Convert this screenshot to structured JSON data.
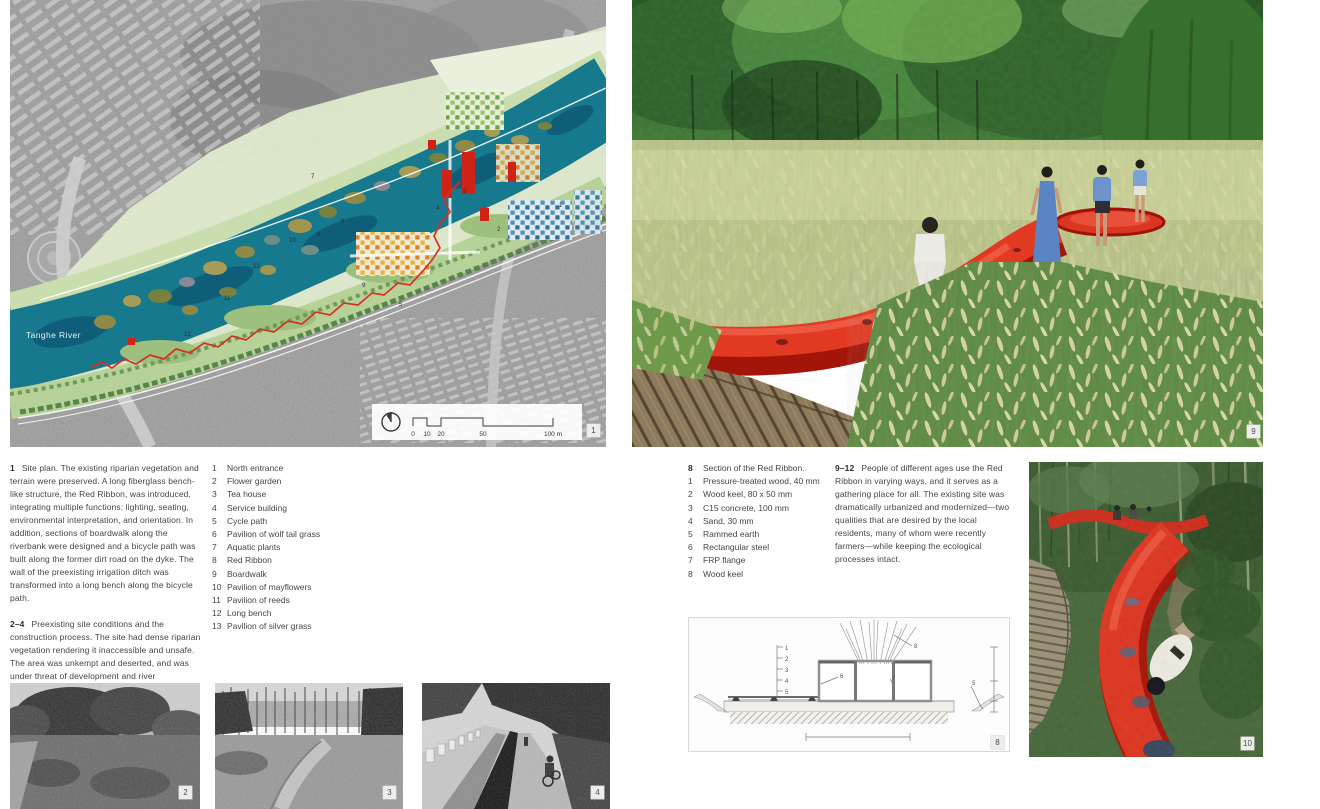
{
  "page": {
    "type": "book-spread",
    "background": "#ffffff"
  },
  "colors": {
    "ribbon_red": "#d93522",
    "river_teal": "#17798d",
    "park_green": "#dde8cb"
  },
  "site_plan": {
    "river_label": "Tanghe River",
    "scale_bar": {
      "ticks": [
        "0",
        "10",
        "20",
        "50",
        "100 m"
      ]
    },
    "map_labels": [
      {
        "n": "1",
        "x": 549,
        "y": 207
      },
      {
        "n": "2",
        "x": 487,
        "y": 231
      },
      {
        "n": "3",
        "x": 453,
        "y": 193
      },
      {
        "n": "4",
        "x": 426,
        "y": 210
      },
      {
        "n": "5",
        "x": 389,
        "y": 306
      },
      {
        "n": "6",
        "x": 331,
        "y": 223
      },
      {
        "n": "7",
        "x": 301,
        "y": 178
      },
      {
        "n": "8",
        "x": 307,
        "y": 236
      },
      {
        "n": "9",
        "x": 352,
        "y": 287
      },
      {
        "n": "10",
        "x": 279,
        "y": 242
      },
      {
        "n": "11",
        "x": 214,
        "y": 300
      },
      {
        "n": "12",
        "x": 174,
        "y": 336
      },
      {
        "n": "13",
        "x": 243,
        "y": 268
      }
    ]
  },
  "captions": {
    "c1": {
      "lead": "1",
      "text": "Site plan. The existing riparian vegetation and terrain were preserved. A long fiberglass bench-like structure, the Red Ribbon, was introduced, integrating multiple functions: lighting, seating, environmental interpretation, and orientation. In addition, sections of boardwalk along the riverbank were designed and a bicycle path was built along the former dirt road on the dyke. The wall of the preexisting irrigation ditch was transformed into a long bench along the bicycle path."
    },
    "c2": {
      "lead": "2–4",
      "text": "Preexisting site conditions and the construction process. The site had dense riparian vegetation rendering it inaccessible and unsafe. The area was unkempt and deserted, and was under threat of development and river channelization."
    },
    "c3": {
      "lead": "9–12",
      "text": "People of different ages use the Red Ribbon in varying ways, and it serves as a gathering place for all. The existing site was dramatically urbanized and modernized—two qualities that are desired by the local residents, many of whom were recently farmers—while keeping the ecological processes intact."
    }
  },
  "plan_legend": {
    "items": [
      {
        "n": "1",
        "label": "North entrance"
      },
      {
        "n": "2",
        "label": "Flower garden"
      },
      {
        "n": "3",
        "label": "Tea house"
      },
      {
        "n": "4",
        "label": "Service building"
      },
      {
        "n": "5",
        "label": "Cycle path"
      },
      {
        "n": "6",
        "label": "Pavilion of wolf tail grass"
      },
      {
        "n": "7",
        "label": "Aquatic plants"
      },
      {
        "n": "8",
        "label": "Red Ribbon"
      },
      {
        "n": "9",
        "label": "Boardwalk"
      },
      {
        "n": "10",
        "label": "Pavilion of mayflowers"
      },
      {
        "n": "11",
        "label": "Pavilion of reeds"
      },
      {
        "n": "12",
        "label": "Long bench"
      },
      {
        "n": "13",
        "label": "Pavilion of silver grass"
      }
    ]
  },
  "section_legend": {
    "lead_n": "8",
    "lead_label": "Section of the Red Ribbon.",
    "items": [
      {
        "n": "1",
        "label": "Pressure-treated wood, 40 mm"
      },
      {
        "n": "2",
        "label": "Wood keel, 80 x 50 mm"
      },
      {
        "n": "3",
        "label": "C15 concrete, 100 mm"
      },
      {
        "n": "4",
        "label": "Sand, 30 mm"
      },
      {
        "n": "5",
        "label": "Rammed earth"
      },
      {
        "n": "6",
        "label": "Rectangular steel"
      },
      {
        "n": "7",
        "label": "FRP flange"
      },
      {
        "n": "8",
        "label": "Wood keel"
      }
    ]
  },
  "section_drawing": {
    "leaders": [
      {
        "n": "1",
        "x": 97,
        "y": 33
      },
      {
        "n": "2",
        "x": 97,
        "y": 44
      },
      {
        "n": "3",
        "x": 97,
        "y": 55
      },
      {
        "n": "4",
        "x": 97,
        "y": 66
      },
      {
        "n": "5",
        "x": 97,
        "y": 77
      },
      {
        "n": "6",
        "x": 152,
        "y": 61
      },
      {
        "n": "7",
        "x": 204,
        "y": 63
      },
      {
        "n": "8",
        "x": 226,
        "y": 31
      },
      {
        "n": "5",
        "x": 284,
        "y": 68
      }
    ]
  },
  "figure_tags": {
    "site_plan": "1",
    "photo_2": "2",
    "photo_3": "3",
    "photo_4": "4",
    "section": "8",
    "photo_9": "9",
    "photo_10": "10"
  }
}
